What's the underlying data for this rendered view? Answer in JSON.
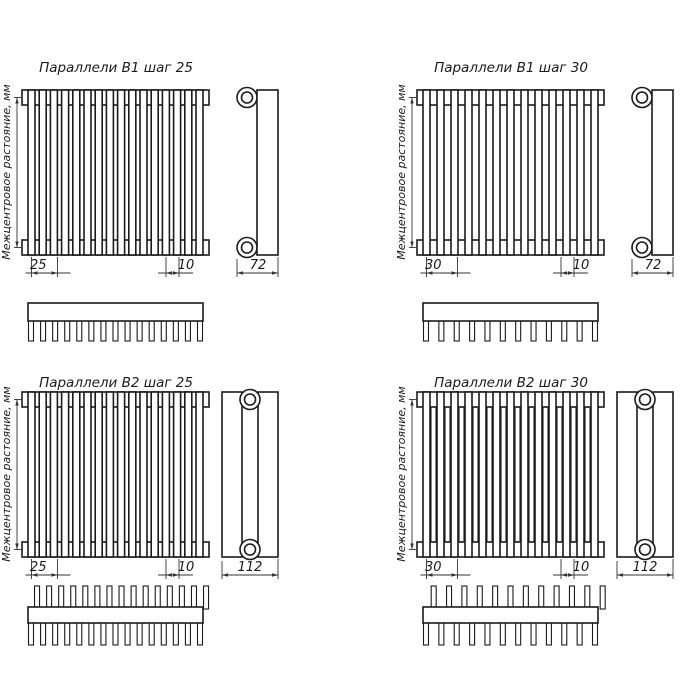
{
  "drawing": {
    "sheet_background": "#ffffff",
    "line_color": "#1b1b1b",
    "dimension_color": "#333333",
    "axis_label": "Межцентровое растояние, мм",
    "quadrants": [
      {
        "id": "b1-step-25",
        "title": "Параллели В1 шаг 25",
        "rows": 1,
        "tube_count": 16,
        "comb_teeth": 15,
        "pitch_label": "25",
        "tube_width_label": "10",
        "depth_label": "72"
      },
      {
        "id": "b1-step-30",
        "title": "Параллели В1 шаг 30",
        "rows": 1,
        "tube_count": 13,
        "comb_teeth": 12,
        "pitch_label": "30",
        "tube_width_label": "10",
        "depth_label": "72"
      },
      {
        "id": "b2-step-25",
        "title": "Параллели В2 шаг 25",
        "rows": 2,
        "tube_count": 16,
        "comb_teeth": 15,
        "pitch_label": "25",
        "tube_width_label": "10",
        "depth_label": "112"
      },
      {
        "id": "b2-step-30",
        "title": "Параллели В2 шаг 30",
        "rows": 2,
        "tube_count": 13,
        "comb_teeth": 12,
        "pitch_label": "30",
        "tube_width_label": "10",
        "depth_label": "112"
      }
    ]
  }
}
